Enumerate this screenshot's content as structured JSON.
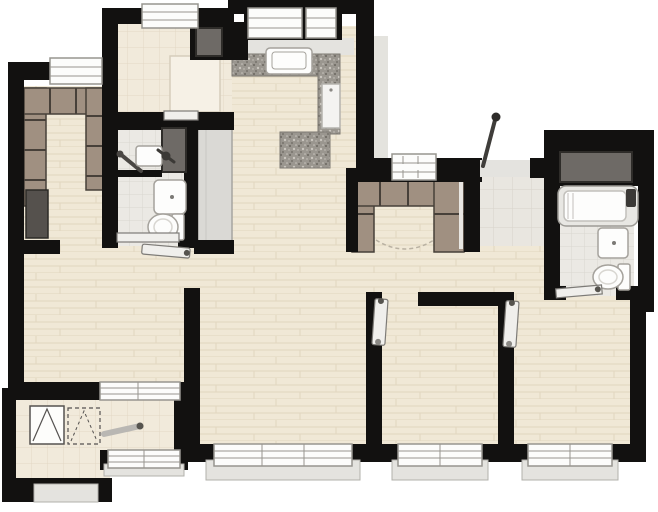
{
  "diagram": {
    "type": "floor-plan",
    "style": "architectural top-down apartment rendering",
    "text_labels": [],
    "rooms": [
      {
        "name": "walk-in-closet",
        "floor": "wood",
        "features": [
          "u-shaped-wardrobe",
          "dark-appliance",
          "window"
        ]
      },
      {
        "name": "utility-room",
        "floor": "cream-tile",
        "features": [
          "glass-enclosure",
          "duct-shaft",
          "sliding-door",
          "window"
        ]
      },
      {
        "name": "kitchen",
        "floor": "wood",
        "features": [
          "granite-counter-l",
          "sink",
          "tall-appliance",
          "peninsula-counter",
          "double-window"
        ]
      },
      {
        "name": "bathroom-left",
        "floor": "bath-tile",
        "features": [
          "shower-bar",
          "hand-sink",
          "faucet",
          "vanity-sink",
          "toilet",
          "duct-shaft",
          "sliding-door",
          "open-door-leaf"
        ]
      },
      {
        "name": "hallway-living-dining",
        "floor": "wood",
        "features": [
          "tall-gray-cabinet"
        ]
      },
      {
        "name": "entry-foyer",
        "floor": "foyer-tile",
        "features": [
          "entry-door-open",
          "threshold"
        ]
      },
      {
        "name": "entry-closet",
        "floor": "wood",
        "features": [
          "u-shaped-wardrobe",
          "window",
          "dashed-threshold-arc"
        ]
      },
      {
        "name": "bathroom-right",
        "floor": "bath-tile",
        "features": [
          "bathtub",
          "faucet",
          "vanity-sink",
          "toilet",
          "duct-shaft",
          "sliding-door"
        ]
      },
      {
        "name": "bedroom-left",
        "floor": "wood",
        "features": [
          "interior-window"
        ]
      },
      {
        "name": "laundry-balcony",
        "floor": "cream-tile",
        "features": [
          "washer-symbol",
          "dashed-dryer-symbol",
          "low-sill"
        ]
      },
      {
        "name": "flex-room",
        "floor": "cream-tile",
        "features": [
          "door-leaf",
          "window"
        ]
      },
      {
        "name": "living-room",
        "floor": "wood",
        "features": [
          "bay-window"
        ]
      },
      {
        "name": "bedroom-middle",
        "floor": "wood",
        "features": [
          "door-leaf",
          "bay-window"
        ]
      },
      {
        "name": "bedroom-right",
        "floor": "wood",
        "features": [
          "door-leaf",
          "bay-window"
        ]
      }
    ]
  },
  "palette": {
    "wall": "#121110",
    "wood": "#f0e8d6",
    "wood-line": "#e1d6bf",
    "tile": "#f1eadb",
    "tile-line": "#e2d8c5",
    "bath-tile": "#ebe9e4",
    "bath-tile-line": "#d9d6d0",
    "foyer-tile": "#e9e6e0",
    "foyer-tile-line": "#d7d3ca",
    "cabinet": "#a09081",
    "cabinet-dark": "#474039",
    "counter": "#9a968f",
    "counter-dark": "#6b6760",
    "counter-light": "#cac6bf",
    "fixture": "#fdfdfc",
    "fixture-line": "#a5a29c",
    "sill": "#e4e3df",
    "sill-line": "#b2b0ab",
    "window-frame": "#fcfcfb",
    "window-line": "#97958f",
    "shaft": "#6e6a66",
    "shaft-line": "#2e2c29",
    "appliance": "#55514d",
    "door-leaf": "#f0efec",
    "door-line": "#7d7b77",
    "gray-cabinet": "#dad9d5",
    "gray-cabinet-line": "#a6a4a0",
    "metal": "#4a4744",
    "enclosure": "#f6f1e6",
    "enclosure-line": "#d6cdbb"
  }
}
